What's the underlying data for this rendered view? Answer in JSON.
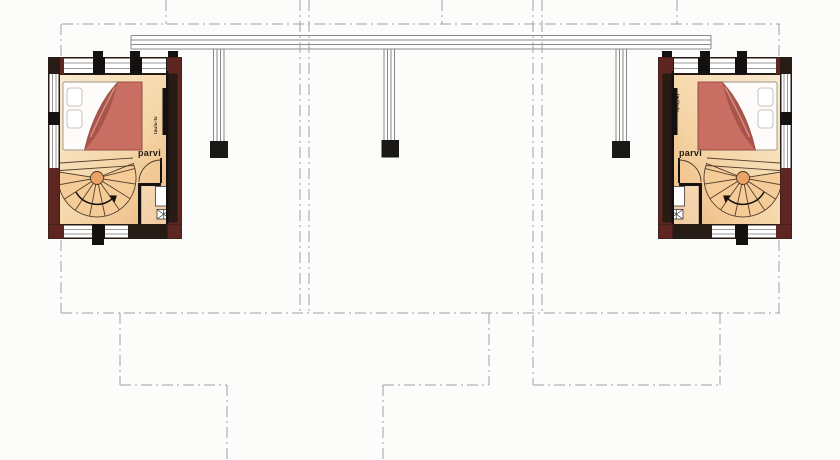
{
  "plan": {
    "units": [
      {
        "id": "left",
        "loft_label": "parvi",
        "tv_label": "taulu-tv"
      },
      {
        "id": "right",
        "loft_label": "parvi",
        "tv_label": "taulu-tv"
      }
    ]
  },
  "colors": {
    "floor-light": "#f9ead0",
    "floor-mid": "#f5d6a8",
    "floor-deep": "#eeb87e",
    "bed-red": "#c96e62",
    "bed-fold": "#a9534a",
    "bed-fold-light": "#d8968a",
    "wall-dark": "#271c15",
    "wall-maroon": "#5d2620",
    "wall-black": "#141110",
    "step-fill": "#f5cb97",
    "step-line": "#54402c",
    "beam-gray": "#8a8a8a",
    "centerline-gray": "#a0a0a0",
    "post-black": "#1b1917",
    "glass-white": "#ffffff",
    "glass-line": "#9b9b9b",
    "label-color": "#241b12"
  }
}
